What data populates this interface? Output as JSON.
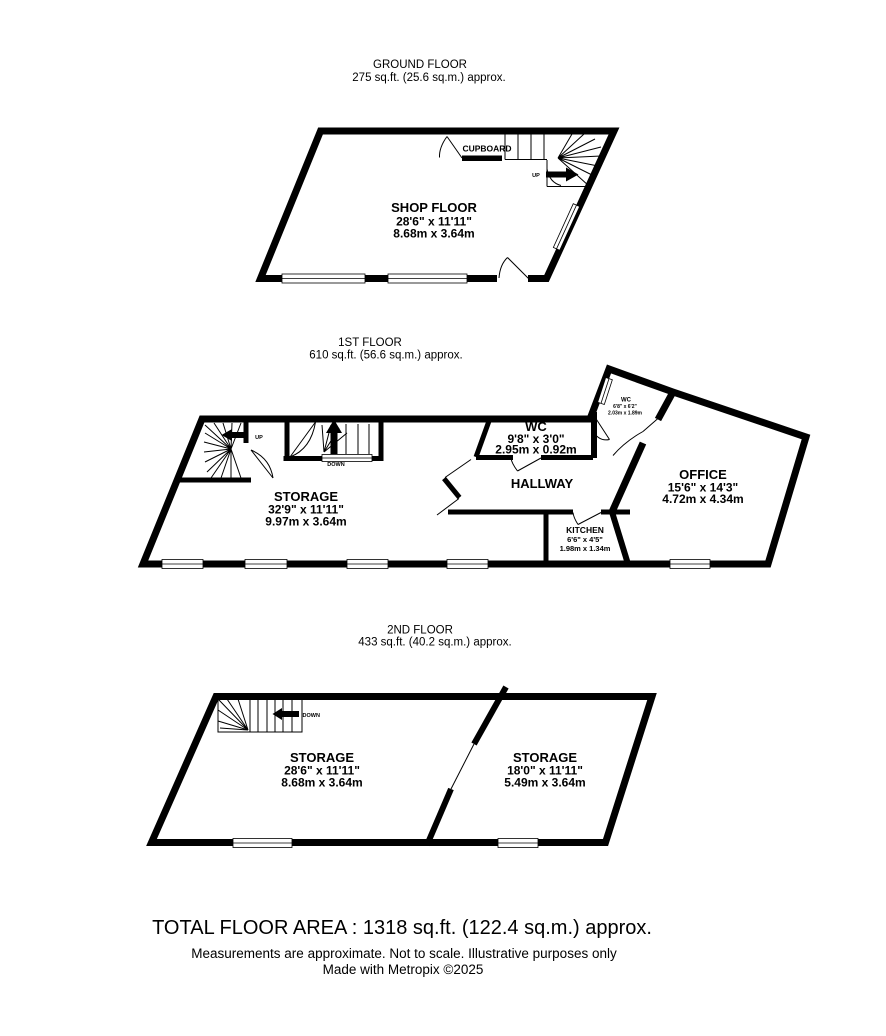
{
  "page": {
    "background": "#ffffff",
    "ink": "#000000"
  },
  "floors": {
    "ground": {
      "title": "GROUND FLOOR",
      "area": "275 sq.ft. (25.6 sq.m.) approx.",
      "shop_floor_name": "SHOP FLOOR",
      "shop_floor_imperial": "28'6\"  x 11'11\"",
      "shop_floor_metric": "8.68m  x 3.64m",
      "cupboard": "CUPBOARD",
      "up": "UP"
    },
    "first": {
      "title": "1ST FLOOR",
      "area": "610 sq.ft. (56.6 sq.m.) approx.",
      "storage_name": "STORAGE",
      "storage_imperial": "32'9\"  x 11'11\"",
      "storage_metric": "9.97m  x 3.64m",
      "wc_name": "WC",
      "wc_imperial": "9'8\"  x 3'0\"",
      "wc_metric": "2.95m  x 0.92m",
      "hallway": "HALLWAY",
      "office_name": "OFFICE",
      "office_imperial": "15'6\"  x 14'3\"",
      "office_metric": "4.72m  x 4.34m",
      "kitchen_name": "KITCHEN",
      "kitchen_imperial": "6'6\"  x 4'5\"",
      "kitchen_metric": "1.98m  x 1.34m",
      "small_wc_name": "WC",
      "small_wc_imperial": "6'8\"  x 6'2\"",
      "small_wc_metric": "2.03m  x 1.89m",
      "up": "UP",
      "down": "DOWN"
    },
    "second": {
      "title": "2ND FLOOR",
      "area": "433 sq.ft. (40.2 sq.m.) approx.",
      "storage_left_name": "STORAGE",
      "storage_left_imperial": "28'6\"  x 11'11\"",
      "storage_left_metric": "8.68m  x 3.64m",
      "storage_right_name": "STORAGE",
      "storage_right_imperial": "18'0\"  x 11'11\"",
      "storage_right_metric": "5.49m  x 3.64m",
      "down": "DOWN"
    }
  },
  "footer": {
    "total": "TOTAL FLOOR AREA : 1318 sq.ft. (122.4 sq.m.) approx.",
    "disclaimer": "Measurements are approximate.  Not to scale.  Illustrative purposes only",
    "credit": "Made with Metropix ©2025"
  }
}
